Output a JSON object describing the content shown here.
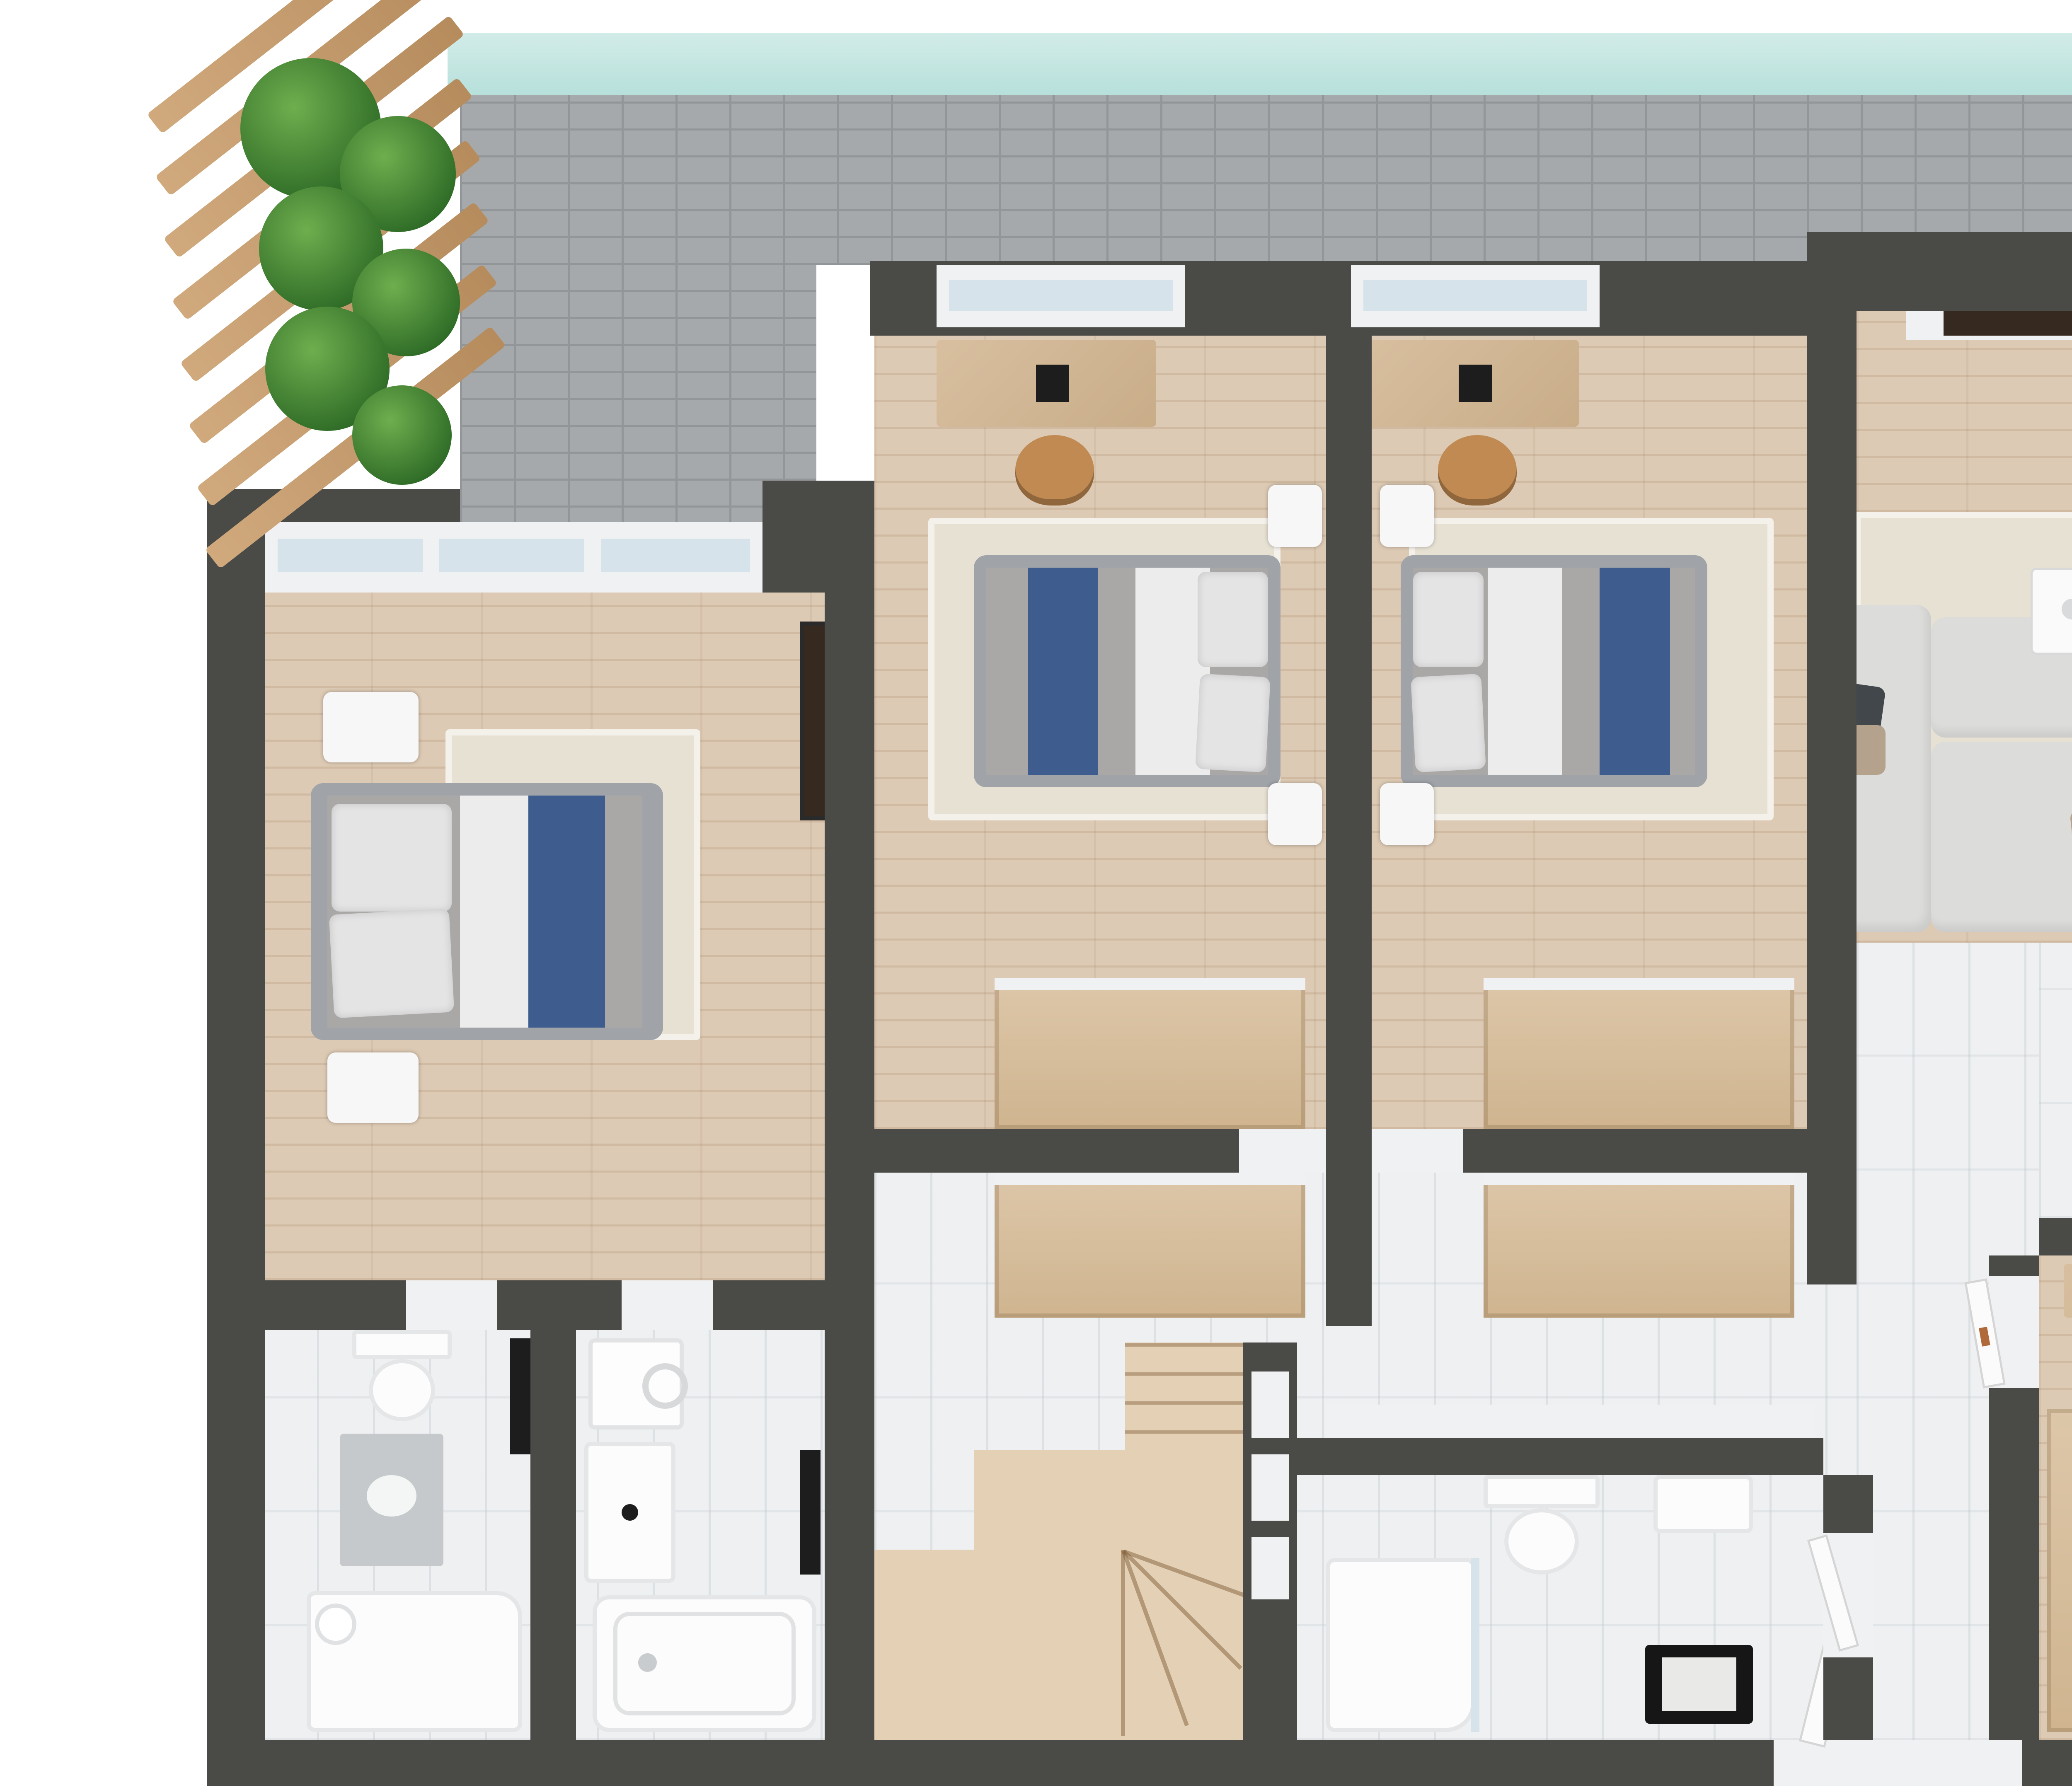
{
  "title": "3D rendered apartment floor plan, top-down view",
  "colors": {
    "wall": "#4a4a47",
    "wallFace": "#f0f1f2",
    "terraceTile": "#a6a9ab",
    "terraceGrout": "#939699",
    "glassTeal": "#b7e0db",
    "glassPane": "#d7e3ea",
    "woodFloor": "#ddcab4",
    "marbleFloor": "#eef0f1",
    "furnitureWood": "#d8bf9f",
    "wardrobeWood": "#ddc7a9",
    "stairWood": "#e4d1b5",
    "rug": "#e6e1d3",
    "bedFrame": "#a0a4a9",
    "duvetGray": "#a9a8a6",
    "duvetBlue": "#3e5c8d",
    "sheetWhite": "#ececec",
    "pillowWhite": "#e4e4e5",
    "sofa": "#dcdcda",
    "cushionDark": "#42474b",
    "cushionTan": "#b4a28c",
    "chairBlue": "#3c5a95",
    "chairBlueDark": "#2f4b7e",
    "chairTan": "#c08a52",
    "lemonYellow": "#e8d23c",
    "plantLight": "#6fae4e",
    "plantDark": "#2d6a26",
    "steel": "#b9bdc0",
    "black": "#1d1d1d",
    "tvBrown": "#36291f",
    "copper": "#b06a3a"
  },
  "rooms": [
    {
      "id": "terrace",
      "name": "wrap-around terrace with gray tile, glass railing, pergola and planters"
    },
    {
      "id": "bedroom-1",
      "name": "west bedroom: double bed with blue runner, two nightstands, wall mirror"
    },
    {
      "id": "bedroom-2",
      "name": "middle bedroom A: desk, tan chair, bed with blue runner, wardrobe"
    },
    {
      "id": "bedroom-3",
      "name": "middle bedroom B: mirrored twin of bedroom A"
    },
    {
      "id": "living-room",
      "name": "living room: modular sofa, coffee table, floor lamp, wall TV"
    },
    {
      "id": "dining-area",
      "name": "indoor dining: wood table, four blue chairs, lemon bowl"
    },
    {
      "id": "outdoor-dining",
      "name": "terrace dining: wood table, four blue chairs, lemon bowl"
    },
    {
      "id": "kitchen",
      "name": "kitchen: L-counter, gas cooktop, oven, sink, dishwasher, pantry niche"
    },
    {
      "id": "bedroom-4",
      "name": "master bedroom: bed, wardrobe, dresser, TV, balcony windows"
    },
    {
      "id": "hallway",
      "name": "central marble hallway with built-in closets"
    },
    {
      "id": "staircase",
      "name": "L-shaped winder staircase in light wood with storage niches"
    },
    {
      "id": "bathroom-1",
      "name": "west bathroom: toilet, vanity, walk-in shower, towel radiator"
    },
    {
      "id": "bathroom-2",
      "name": "second bathroom: washing machine, vanity, bathtub, towel radiator"
    },
    {
      "id": "bathroom-3",
      "name": "hall bathroom: shower, wall-hung toilet, basin, towel bench"
    },
    {
      "id": "entry",
      "name": "entry with open white door"
    }
  ],
  "furniture_counts": {
    "beds": 4,
    "blue_dining_chairs": 8,
    "desks": 2,
    "desk_chairs": 2,
    "nightstands": 8,
    "sofas": 1,
    "bathtubs": 1,
    "showers": 2,
    "toilets": 2,
    "washing_machines": 1,
    "plant_clusters": 3,
    "lemon_bowls": 2,
    "tvs": 2
  }
}
